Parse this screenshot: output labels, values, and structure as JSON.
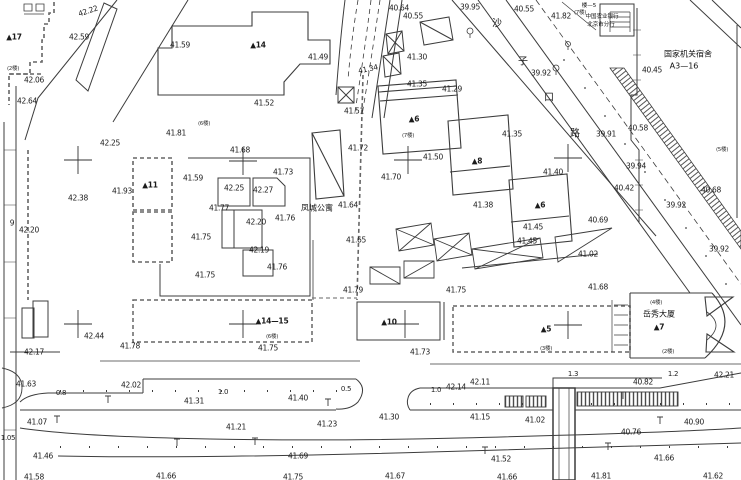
{
  "drawing": {
    "kind": "cadastral survey site plan (CAD)",
    "background": "#ffffff",
    "line_color": "#3c3c3c",
    "dashed_boundary_color": "#666666",
    "text_color": "#1b1b1b"
  },
  "labels": {
    "spot_elevations": [
      {
        "t": "42.22",
        "x": 88,
        "y": 11,
        "r": -18
      },
      {
        "t": "42.59",
        "x": 79,
        "y": 37
      },
      {
        "t": "42.06",
        "x": 34,
        "y": 80
      },
      {
        "t": "42.64",
        "x": 27,
        "y": 101
      },
      {
        "t": "41.59",
        "x": 180,
        "y": 45
      },
      {
        "t": "41.49",
        "x": 318,
        "y": 57
      },
      {
        "t": "41.52",
        "x": 264,
        "y": 103
      },
      {
        "t": "41.51",
        "x": 354,
        "y": 111
      },
      {
        "t": "40.64",
        "x": 399,
        "y": 8
      },
      {
        "t": "40.55",
        "x": 413,
        "y": 16
      },
      {
        "t": "39.95",
        "x": 470,
        "y": 7
      },
      {
        "t": "40.55",
        "x": 524,
        "y": 9
      },
      {
        "t": "41.82",
        "x": 561,
        "y": 16
      },
      {
        "t": "41.34",
        "x": 368,
        "y": 69,
        "r": -12
      },
      {
        "t": "41.30",
        "x": 417,
        "y": 57
      },
      {
        "t": "41.35",
        "x": 417,
        "y": 84
      },
      {
        "t": "41.29",
        "x": 452,
        "y": 89
      },
      {
        "t": "39.92",
        "x": 541,
        "y": 73
      },
      {
        "t": "40.45",
        "x": 652,
        "y": 70
      },
      {
        "t": "40.58",
        "x": 638,
        "y": 128
      },
      {
        "t": "39.91",
        "x": 606,
        "y": 134
      },
      {
        "t": "41.35",
        "x": 512,
        "y": 134
      },
      {
        "t": "39.94",
        "x": 636,
        "y": 166
      },
      {
        "t": "40.42",
        "x": 624,
        "y": 188
      },
      {
        "t": "40.68",
        "x": 711,
        "y": 190
      },
      {
        "t": "39.92",
        "x": 676,
        "y": 205
      },
      {
        "t": "40.69",
        "x": 598,
        "y": 220
      },
      {
        "t": "41.40",
        "x": 553,
        "y": 172
      },
      {
        "t": "42.25",
        "x": 110,
        "y": 143
      },
      {
        "t": "41.81",
        "x": 176,
        "y": 133
      },
      {
        "t": "41.68",
        "x": 240,
        "y": 150
      },
      {
        "t": "41.93",
        "x": 122,
        "y": 191
      },
      {
        "t": "42.38",
        "x": 78,
        "y": 198
      },
      {
        "t": "41.59",
        "x": 193,
        "y": 178
      },
      {
        "t": "41.73",
        "x": 283,
        "y": 172
      },
      {
        "t": "42.25",
        "x": 234,
        "y": 188
      },
      {
        "t": "42.27",
        "x": 263,
        "y": 190
      },
      {
        "t": "41.77",
        "x": 219,
        "y": 208
      },
      {
        "t": "42.20",
        "x": 256,
        "y": 222
      },
      {
        "t": "41.76",
        "x": 285,
        "y": 218
      },
      {
        "t": "41.75",
        "x": 201,
        "y": 237
      },
      {
        "t": "42.19",
        "x": 259,
        "y": 250
      },
      {
        "t": "41.76",
        "x": 277,
        "y": 267
      },
      {
        "t": "41.75",
        "x": 205,
        "y": 275
      },
      {
        "t": "41.72",
        "x": 358,
        "y": 148
      },
      {
        "t": "41.50",
        "x": 433,
        "y": 157
      },
      {
        "t": "41.70",
        "x": 391,
        "y": 177
      },
      {
        "t": "41.64",
        "x": 348,
        "y": 205
      },
      {
        "t": "41.38",
        "x": 483,
        "y": 205
      },
      {
        "t": "41.65",
        "x": 356,
        "y": 240
      },
      {
        "t": "41.45",
        "x": 533,
        "y": 227
      },
      {
        "t": "41.45",
        "x": 527,
        "y": 241
      },
      {
        "t": "41.02",
        "x": 588,
        "y": 254
      },
      {
        "t": "39.92",
        "x": 719,
        "y": 249
      },
      {
        "t": "41.68",
        "x": 598,
        "y": 287
      },
      {
        "t": "41.79",
        "x": 353,
        "y": 290
      },
      {
        "t": "41.75",
        "x": 456,
        "y": 290
      },
      {
        "t": "42.44",
        "x": 94,
        "y": 336
      },
      {
        "t": "42.17",
        "x": 34,
        "y": 352
      },
      {
        "t": "41.78",
        "x": 130,
        "y": 346
      },
      {
        "t": "41.75",
        "x": 268,
        "y": 348
      },
      {
        "t": "41.73",
        "x": 420,
        "y": 352
      },
      {
        "t": "41.63",
        "x": 26,
        "y": 384
      },
      {
        "t": "42.02",
        "x": 131,
        "y": 385
      },
      {
        "t": "41.31",
        "x": 194,
        "y": 401
      },
      {
        "t": "41.07",
        "x": 37,
        "y": 422
      },
      {
        "t": "41.21",
        "x": 236,
        "y": 427
      },
      {
        "t": "41.46",
        "x": 43,
        "y": 456
      },
      {
        "t": "41.58",
        "x": 34,
        "y": 477
      },
      {
        "t": "41.66",
        "x": 166,
        "y": 476
      },
      {
        "t": "41.40",
        "x": 298,
        "y": 398
      },
      {
        "t": "41.30",
        "x": 389,
        "y": 417
      },
      {
        "t": "41.23",
        "x": 327,
        "y": 424
      },
      {
        "t": "42.14",
        "x": 456,
        "y": 387
      },
      {
        "t": "42.11",
        "x": 480,
        "y": 382
      },
      {
        "t": "41.15",
        "x": 480,
        "y": 417
      },
      {
        "t": "41.69",
        "x": 298,
        "y": 456
      },
      {
        "t": "41.75",
        "x": 293,
        "y": 477
      },
      {
        "t": "41.67",
        "x": 395,
        "y": 476
      },
      {
        "t": "42.21",
        "x": 724,
        "y": 375
      },
      {
        "t": "40.82",
        "x": 643,
        "y": 382
      },
      {
        "t": "41.02",
        "x": 535,
        "y": 420
      },
      {
        "t": "40.90",
        "x": 694,
        "y": 422
      },
      {
        "t": "40.76",
        "x": 631,
        "y": 432
      },
      {
        "t": "41.52",
        "x": 501,
        "y": 459
      },
      {
        "t": "41.66",
        "x": 664,
        "y": 458
      },
      {
        "t": "41.66",
        "x": 507,
        "y": 477
      },
      {
        "t": "41.81",
        "x": 601,
        "y": 476
      },
      {
        "t": "41.62",
        "x": 713,
        "y": 476
      }
    ],
    "road_widths": [
      {
        "t": "0.8",
        "x": 61,
        "y": 393
      },
      {
        "t": "1.0",
        "x": 223,
        "y": 392
      },
      {
        "t": "0.5",
        "x": 346,
        "y": 389
      },
      {
        "t": "1.0",
        "x": 436,
        "y": 390
      },
      {
        "t": "1.3",
        "x": 573,
        "y": 374
      },
      {
        "t": "1.2",
        "x": 673,
        "y": 374
      },
      {
        "t": "1.05",
        "x": 8,
        "y": 438
      }
    ],
    "building_numbers": [
      {
        "t": "▲17",
        "x": 14,
        "y": 37
      },
      {
        "t": "▲14",
        "x": 258,
        "y": 45
      },
      {
        "t": "▲11",
        "x": 150,
        "y": 185
      },
      {
        "t": "▲6",
        "x": 414,
        "y": 119
      },
      {
        "t": "▲8",
        "x": 477,
        "y": 161
      },
      {
        "t": "▲6",
        "x": 540,
        "y": 205
      },
      {
        "t": "▲10",
        "x": 389,
        "y": 322
      },
      {
        "t": "▲14—15",
        "x": 272,
        "y": 321
      },
      {
        "t": "▲5",
        "x": 546,
        "y": 329
      },
      {
        "t": "▲7",
        "x": 659,
        "y": 327
      }
    ],
    "floor_counts": [
      {
        "t": "(2楼)",
        "x": 13,
        "y": 68
      },
      {
        "t": "(6楼)",
        "x": 204,
        "y": 123
      },
      {
        "t": "(7楼)",
        "x": 580,
        "y": 12
      },
      {
        "t": "(7楼)",
        "x": 408,
        "y": 135
      },
      {
        "t": "(5楼)",
        "x": 722,
        "y": 149
      },
      {
        "t": "(6楼)",
        "x": 272,
        "y": 336
      },
      {
        "t": "(3楼)",
        "x": 546,
        "y": 348
      },
      {
        "t": "(2楼)",
        "x": 668,
        "y": 351
      },
      {
        "t": "(4楼)",
        "x": 656,
        "y": 302
      }
    ],
    "names": [
      {
        "t": "楼—5",
        "x": 589,
        "y": 5,
        "cls": "cn-sm"
      },
      {
        "t": "中国农业银行",
        "x": 602,
        "y": 16,
        "cls": "cn-sm"
      },
      {
        "t": "北京市分行",
        "x": 601,
        "y": 24,
        "cls": "cn-sm"
      },
      {
        "t": "国家机关宿舍",
        "x": 688,
        "y": 54
      },
      {
        "t": "A3—16",
        "x": 684,
        "y": 66
      },
      {
        "t": "凤城公寓",
        "x": 317,
        "y": 208
      },
      {
        "t": "岳秀大厦",
        "x": 659,
        "y": 314
      }
    ],
    "street_name_chars": [
      {
        "t": "沙",
        "x": 497,
        "y": 22
      },
      {
        "t": "子",
        "x": 523,
        "y": 60
      },
      {
        "t": "口",
        "x": 549,
        "y": 96
      },
      {
        "t": "路",
        "x": 575,
        "y": 132
      }
    ],
    "misc": [
      {
        "t": "9",
        "x": 12,
        "y": 223
      },
      {
        "t": "42.20",
        "x": 29,
        "y": 230
      }
    ]
  }
}
